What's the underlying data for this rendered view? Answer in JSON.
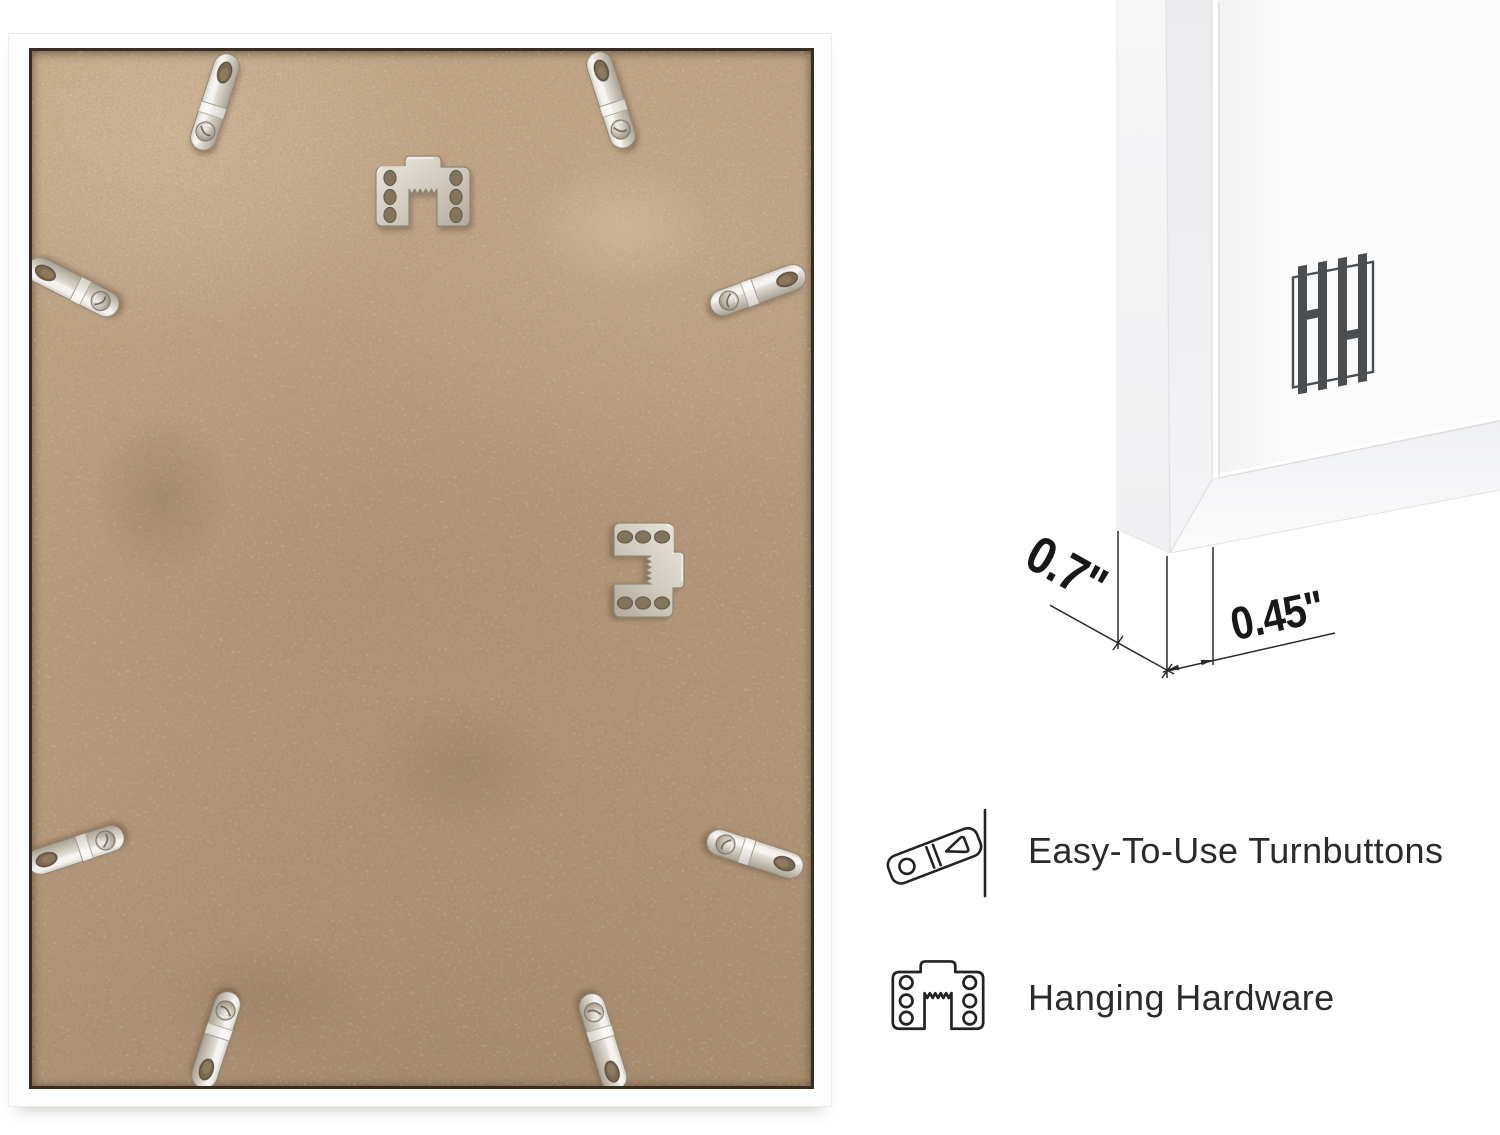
{
  "detail_view": {
    "depth_dimension": "0.7\"",
    "face_dimension": "0.45\"",
    "brand_monogram": "HH"
  },
  "features": [
    {
      "icon": "turnbutton-line-icon",
      "label": "Easy-To-Use Turnbuttons"
    },
    {
      "icon": "hanging-hardware-line-icon",
      "label": "Hanging Hardware"
    }
  ],
  "back_view": {
    "turnbutton_count": 8,
    "sawtooth_hanger_count": 2
  },
  "colors": {
    "board_tan": "#b99b7e",
    "frame_white": "#fdfdfd",
    "metal_light": "#f1efe9",
    "metal_dark": "#a8a191",
    "line_art": "#232323",
    "logo_gray": "#4b4e50"
  }
}
